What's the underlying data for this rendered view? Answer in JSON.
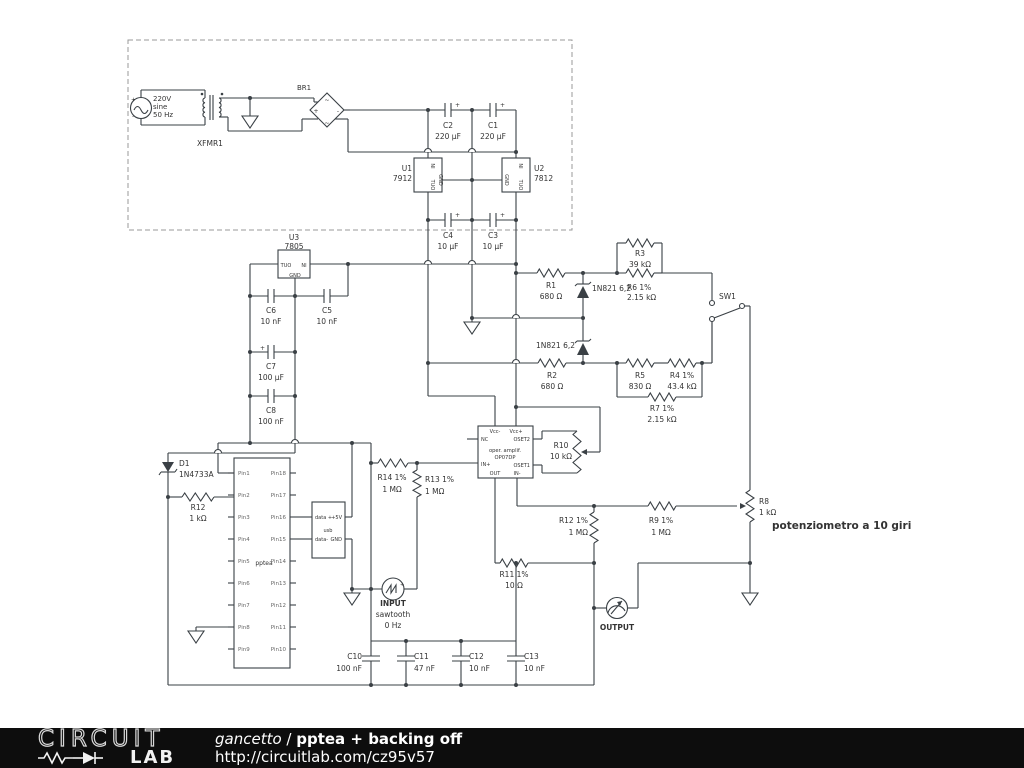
{
  "labels": {
    "v220a": "220V",
    "v220b": "sine",
    "v220c": "50 Hz",
    "src_plus": "+",
    "src_minus": "-",
    "xfmr1": "XFMR1",
    "br1": "BR1",
    "br_plus": "+",
    "br_minus": "-",
    "br_s1": "~",
    "br_s2": "~",
    "c2": "C2",
    "c2v": "220 µF",
    "c2p": "+",
    "c1": "C1",
    "c1v": "220 µF",
    "c1p": "+",
    "u1": "U1",
    "u1v": "7912",
    "u1in": "NI",
    "u1gnd": "GND",
    "u1out": "TUO",
    "u2": "U2",
    "u2v": "7812",
    "u2in": "NI",
    "u2gnd": "GND",
    "u2out": "TUO",
    "c4": "C4",
    "c4v": "10 µF",
    "c4p": "+",
    "c3": "C3",
    "c3v": "10 µF",
    "c3p": "+",
    "u3": "U3",
    "u3v": "7805",
    "u3out": "TUO",
    "u3in": "NI",
    "u3gnd": "GND",
    "c6": "C6",
    "c6v": "10 nF",
    "c5": "C5",
    "c5v": "10 nF",
    "c7": "C7",
    "c7v": "100 µF",
    "c7p": "+",
    "c8": "C8",
    "c8v": "100 nF",
    "r1": "R1",
    "r1v": "680 Ω",
    "z1": "1N821 6,2",
    "z2": "1N821 6,2",
    "r3": "R3",
    "r3v": "39 kΩ",
    "r6": "R6 1%",
    "r6v": "2.15 kΩ",
    "sw1": "SW1",
    "r2": "R2",
    "r2v": "680 Ω",
    "r5": "R5",
    "r5v": "830 Ω",
    "r4": "R4 1%",
    "r4v": "43.4 kΩ",
    "r7": "R7 1%",
    "r7v": "2.15 kΩ",
    "vccm": "Vcc-",
    "vccp": "Vcc+",
    "nc": "NC",
    "oset2": "OSET2",
    "inp": "IN+",
    "oset1": "OSET1",
    "outp": "OUT",
    "inm": "IN-",
    "oa1": "oper. amplif.",
    "oa2": "OP07DP",
    "r10": "R10",
    "r10v": "10 kΩ",
    "d1": "D1",
    "d1v": "1N4733A",
    "r12k": "R12",
    "r12kv": "1 kΩ",
    "pin1": "Pin1",
    "pin2": "Pin2",
    "pin3": "Pin3",
    "pin4": "Pin4",
    "pin5": "Pin5",
    "pin6": "Pin6",
    "pin7": "Pin7",
    "pin8": "Pin8",
    "pin9": "Pin9",
    "pin10": "Pin10",
    "pin11": "Pin11",
    "pin12": "Pin12",
    "pin13": "Pin13",
    "pin14": "Pin14",
    "pin15": "Pin15",
    "pin16": "Pin16",
    "pin17": "Pin17",
    "pin18": "Pin18",
    "pptea": "pptea",
    "usb_dp": "data +",
    "usb_5v": "+5V",
    "usb": "usb",
    "usb_dm": "data-",
    "usb_gnd": "GND",
    "r14": "R14 1%",
    "r14v": "1 MΩ",
    "r13": "R13 1%",
    "r13v": "1 MΩ",
    "input1": "INPUT",
    "input2": "sawtooth",
    "input3": "0 Hz",
    "input_plus": "+",
    "r12m": "R12 1%",
    "r12mv": "1 MΩ",
    "r11": "R11 1%",
    "r11v": "10 Ω",
    "r9": "R9 1%",
    "r9v": "1 MΩ",
    "r8": "R8",
    "r8v": "1 kΩ",
    "pot": "potenziometro a 10 giri",
    "output": "OUTPUT",
    "c10": "C10",
    "c10v": "100 nF",
    "c11": "C11",
    "c11v": "47 nF",
    "c12": "C12",
    "c12v": "10 nF",
    "c13": "C13",
    "c13v": "10 nF"
  },
  "footer": {
    "brand_top": "CIRCUIT",
    "brand_bottom": "LAB",
    "author": "gancetto",
    "sep": " / ",
    "title": "pptea + backing off",
    "url": "http://circuitlab.com/cz95v57"
  },
  "colors": {
    "wire": "#3a4045",
    "label": "#333333",
    "pin_text": "#666666",
    "footer_bg": "#0d0d0d"
  }
}
